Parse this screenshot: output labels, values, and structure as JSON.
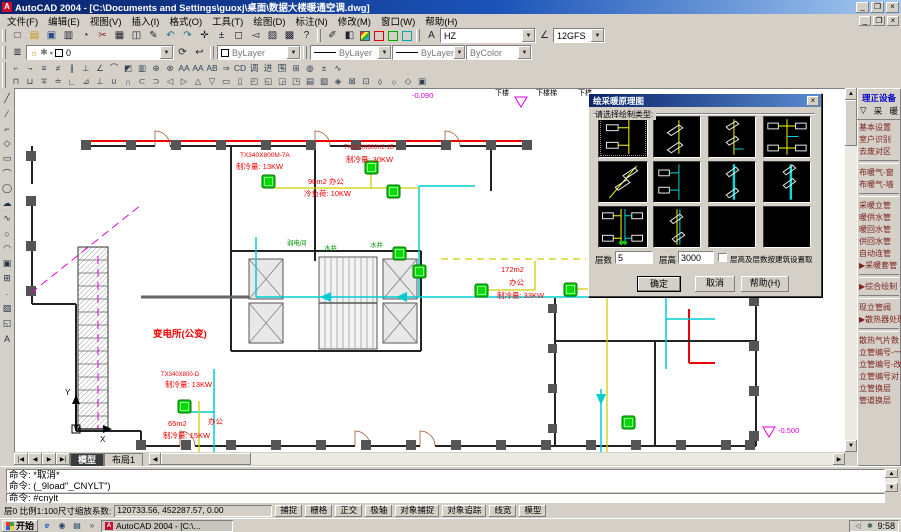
{
  "window": {
    "title": "AutoCAD 2004 - [C:\\Documents and Settings\\guoxj\\桌面\\数据大楼暖通空调.dwg]",
    "minimize": "_",
    "restore": "❐",
    "close": "×"
  },
  "menu": {
    "items": [
      "文件(F)",
      "编辑(E)",
      "视图(V)",
      "插入(I)",
      "格式(O)",
      "工具(T)",
      "绘图(D)",
      "标注(N)",
      "修改(M)",
      "窗口(W)",
      "帮助(H)"
    ]
  },
  "toolbars": {
    "standard": [
      {
        "glyph": "□",
        "name": "new-icon"
      },
      {
        "glyph": "▤",
        "name": "open-icon"
      },
      {
        "glyph": "▣",
        "name": "save-icon"
      },
      {
        "glyph": "▥",
        "name": "print-icon"
      },
      {
        "glyph": "◔",
        "name": "print-preview-icon"
      },
      {
        "glyph": "✂",
        "name": "cut-icon"
      },
      {
        "glyph": "▦",
        "name": "copy-icon"
      },
      {
        "glyph": "◫",
        "name": "paste-icon"
      },
      {
        "glyph": "✎",
        "name": "match-properties-icon"
      },
      {
        "glyph": "↶",
        "name": "undo-icon"
      },
      {
        "glyph": "↷",
        "name": "redo-icon"
      },
      {
        "glyph": "✛",
        "name": "pan-icon"
      },
      {
        "glyph": "±",
        "name": "zoom-realtime-icon"
      },
      {
        "glyph": "◻",
        "name": "zoom-window-icon"
      },
      {
        "glyph": "◅",
        "name": "zoom-previous-icon"
      },
      {
        "glyph": "▨",
        "name": "properties-icon"
      },
      {
        "glyph": "▩",
        "name": "designcenter-icon"
      },
      {
        "glyph": "?",
        "name": "help-icon"
      }
    ],
    "style": {
      "text_icon": "A",
      "text_style": "HZ",
      "dim_icon": "∠",
      "dim_style": "12GFS"
    },
    "layers": {
      "icon": "≣",
      "bulb": "☼",
      "freeze": "✱",
      "lock": "▪",
      "current": "0",
      "make_current_icon": "⟳",
      "previous_icon": "↩",
      "color": "ByLayer",
      "linetype": "ByLayer",
      "lineweight": "ByLayer",
      "plotstyle": "ByColor"
    },
    "row3": [
      "⌐",
      "¬",
      "≡",
      "≠",
      "∥",
      "⊥",
      "∠",
      "⌒",
      "◩",
      "▥",
      "⊕",
      "⊗",
      "AA",
      "AA",
      "AB",
      "⇒",
      "CD",
      "调",
      "进",
      "围",
      "⊞",
      "◍",
      "±",
      "∿"
    ],
    "row4": [
      "⊓",
      "⊔",
      "∓",
      "≐",
      "∟",
      "⊿",
      "⊥",
      "∪",
      "∩",
      "⊂",
      "⊃",
      "◁",
      "▷",
      "△",
      "▽",
      "▭",
      "▯",
      "◰",
      "◱",
      "◲",
      "◳",
      "▤",
      "▧",
      "◈",
      "⊠",
      "⊡",
      "◊",
      "○",
      "◇",
      "▣"
    ],
    "draw": [
      {
        "glyph": "╱",
        "name": "line-icon"
      },
      {
        "glyph": "⁄",
        "name": "construction-line-icon"
      },
      {
        "glyph": "⌐",
        "name": "polyline-icon"
      },
      {
        "glyph": "◇",
        "name": "polygon-icon"
      },
      {
        "glyph": "▭",
        "name": "rectangle-icon"
      },
      {
        "glyph": "⌒",
        "name": "arc-icon"
      },
      {
        "glyph": "◯",
        "name": "circle-icon"
      },
      {
        "glyph": "☁",
        "name": "revision-cloud-icon"
      },
      {
        "glyph": "∿",
        "name": "spline-icon"
      },
      {
        "glyph": "○",
        "name": "ellipse-icon"
      },
      {
        "glyph": "◠",
        "name": "ellipse-arc-icon"
      },
      {
        "glyph": "▣",
        "name": "insert-block-icon"
      },
      {
        "glyph": "⊞",
        "name": "make-block-icon"
      },
      {
        "glyph": "·",
        "name": "point-icon"
      },
      {
        "glyph": "▨",
        "name": "hatch-icon"
      },
      {
        "glyph": "◱",
        "name": "region-icon"
      },
      {
        "glyph": "A",
        "name": "mtext-icon"
      }
    ]
  },
  "palette": {
    "title": "理正设备",
    "collapse_icon": "▽",
    "category_left": "采",
    "category_right": "暖",
    "items": [
      "基本设置",
      "室户识别",
      "去废对区",
      "",
      "布暖气-窗",
      "布暖气-墙",
      "",
      "采暖立管",
      "暖供水管",
      "暖回水管",
      "供回水管",
      "自动连管",
      "▶采暖套管",
      "",
      "▶综合绘制",
      "",
      "现立管阀",
      "▶散热器处理",
      "",
      "散热气片数",
      "立管编号-一",
      "立管编号-改",
      "立管编号对",
      "立管换层",
      "管道换层"
    ]
  },
  "dialog": {
    "title": "绘采暖原理图",
    "close": "×",
    "prompt": "请选择绘制类型:",
    "floors_label": "层数",
    "floors_value": "5",
    "height_label": "层高",
    "height_value": "3000",
    "checkbox_label": "层高及层数按建筑设置取",
    "ok": "确定",
    "cancel": "取消",
    "help": "帮助(H)"
  },
  "drawing": {
    "labels": [
      "变电所(公变)",
      "TX340X800M-7A",
      "制冷量: 13KW",
      "TX21.8X800X2-1B",
      "制冷量: 30KW",
      "90m2  办公",
      "冷负荷: 10KW",
      "172m2",
      "办公",
      "制冷量: 33KW",
      "65m2",
      "办公",
      "制冷量: 15KW",
      "TX340X800-D",
      "制冷量: 13KW",
      "弱电间",
      "水井",
      "水井",
      "下楼",
      "下楼梯",
      "下楼",
      "-0.090",
      "-0.500",
      "Y",
      "X",
      "W"
    ]
  },
  "tabs": {
    "nav": [
      "|◀",
      "◀",
      "▶",
      "▶|"
    ],
    "model": "模型",
    "layout1": "布局1"
  },
  "command": {
    "line1": "命令: *取消*",
    "line2": "命令: (_9load\"_CNYLT\")",
    "current": "命令: #cnylt"
  },
  "status": {
    "info": "层0 比例1:100尺寸缩放系数:",
    "coords": "120733.56, 452287.57, 0.00",
    "toggles": [
      "捕捉",
      "栅格",
      "正交",
      "极轴",
      "对象捕捉",
      "对象追踪",
      "线宽",
      "模型"
    ]
  },
  "taskbar": {
    "start": "开始",
    "ie": "e",
    "overflow": "»",
    "task": "AutoCAD 2004 - [C:\\...",
    "time": "9:58"
  }
}
